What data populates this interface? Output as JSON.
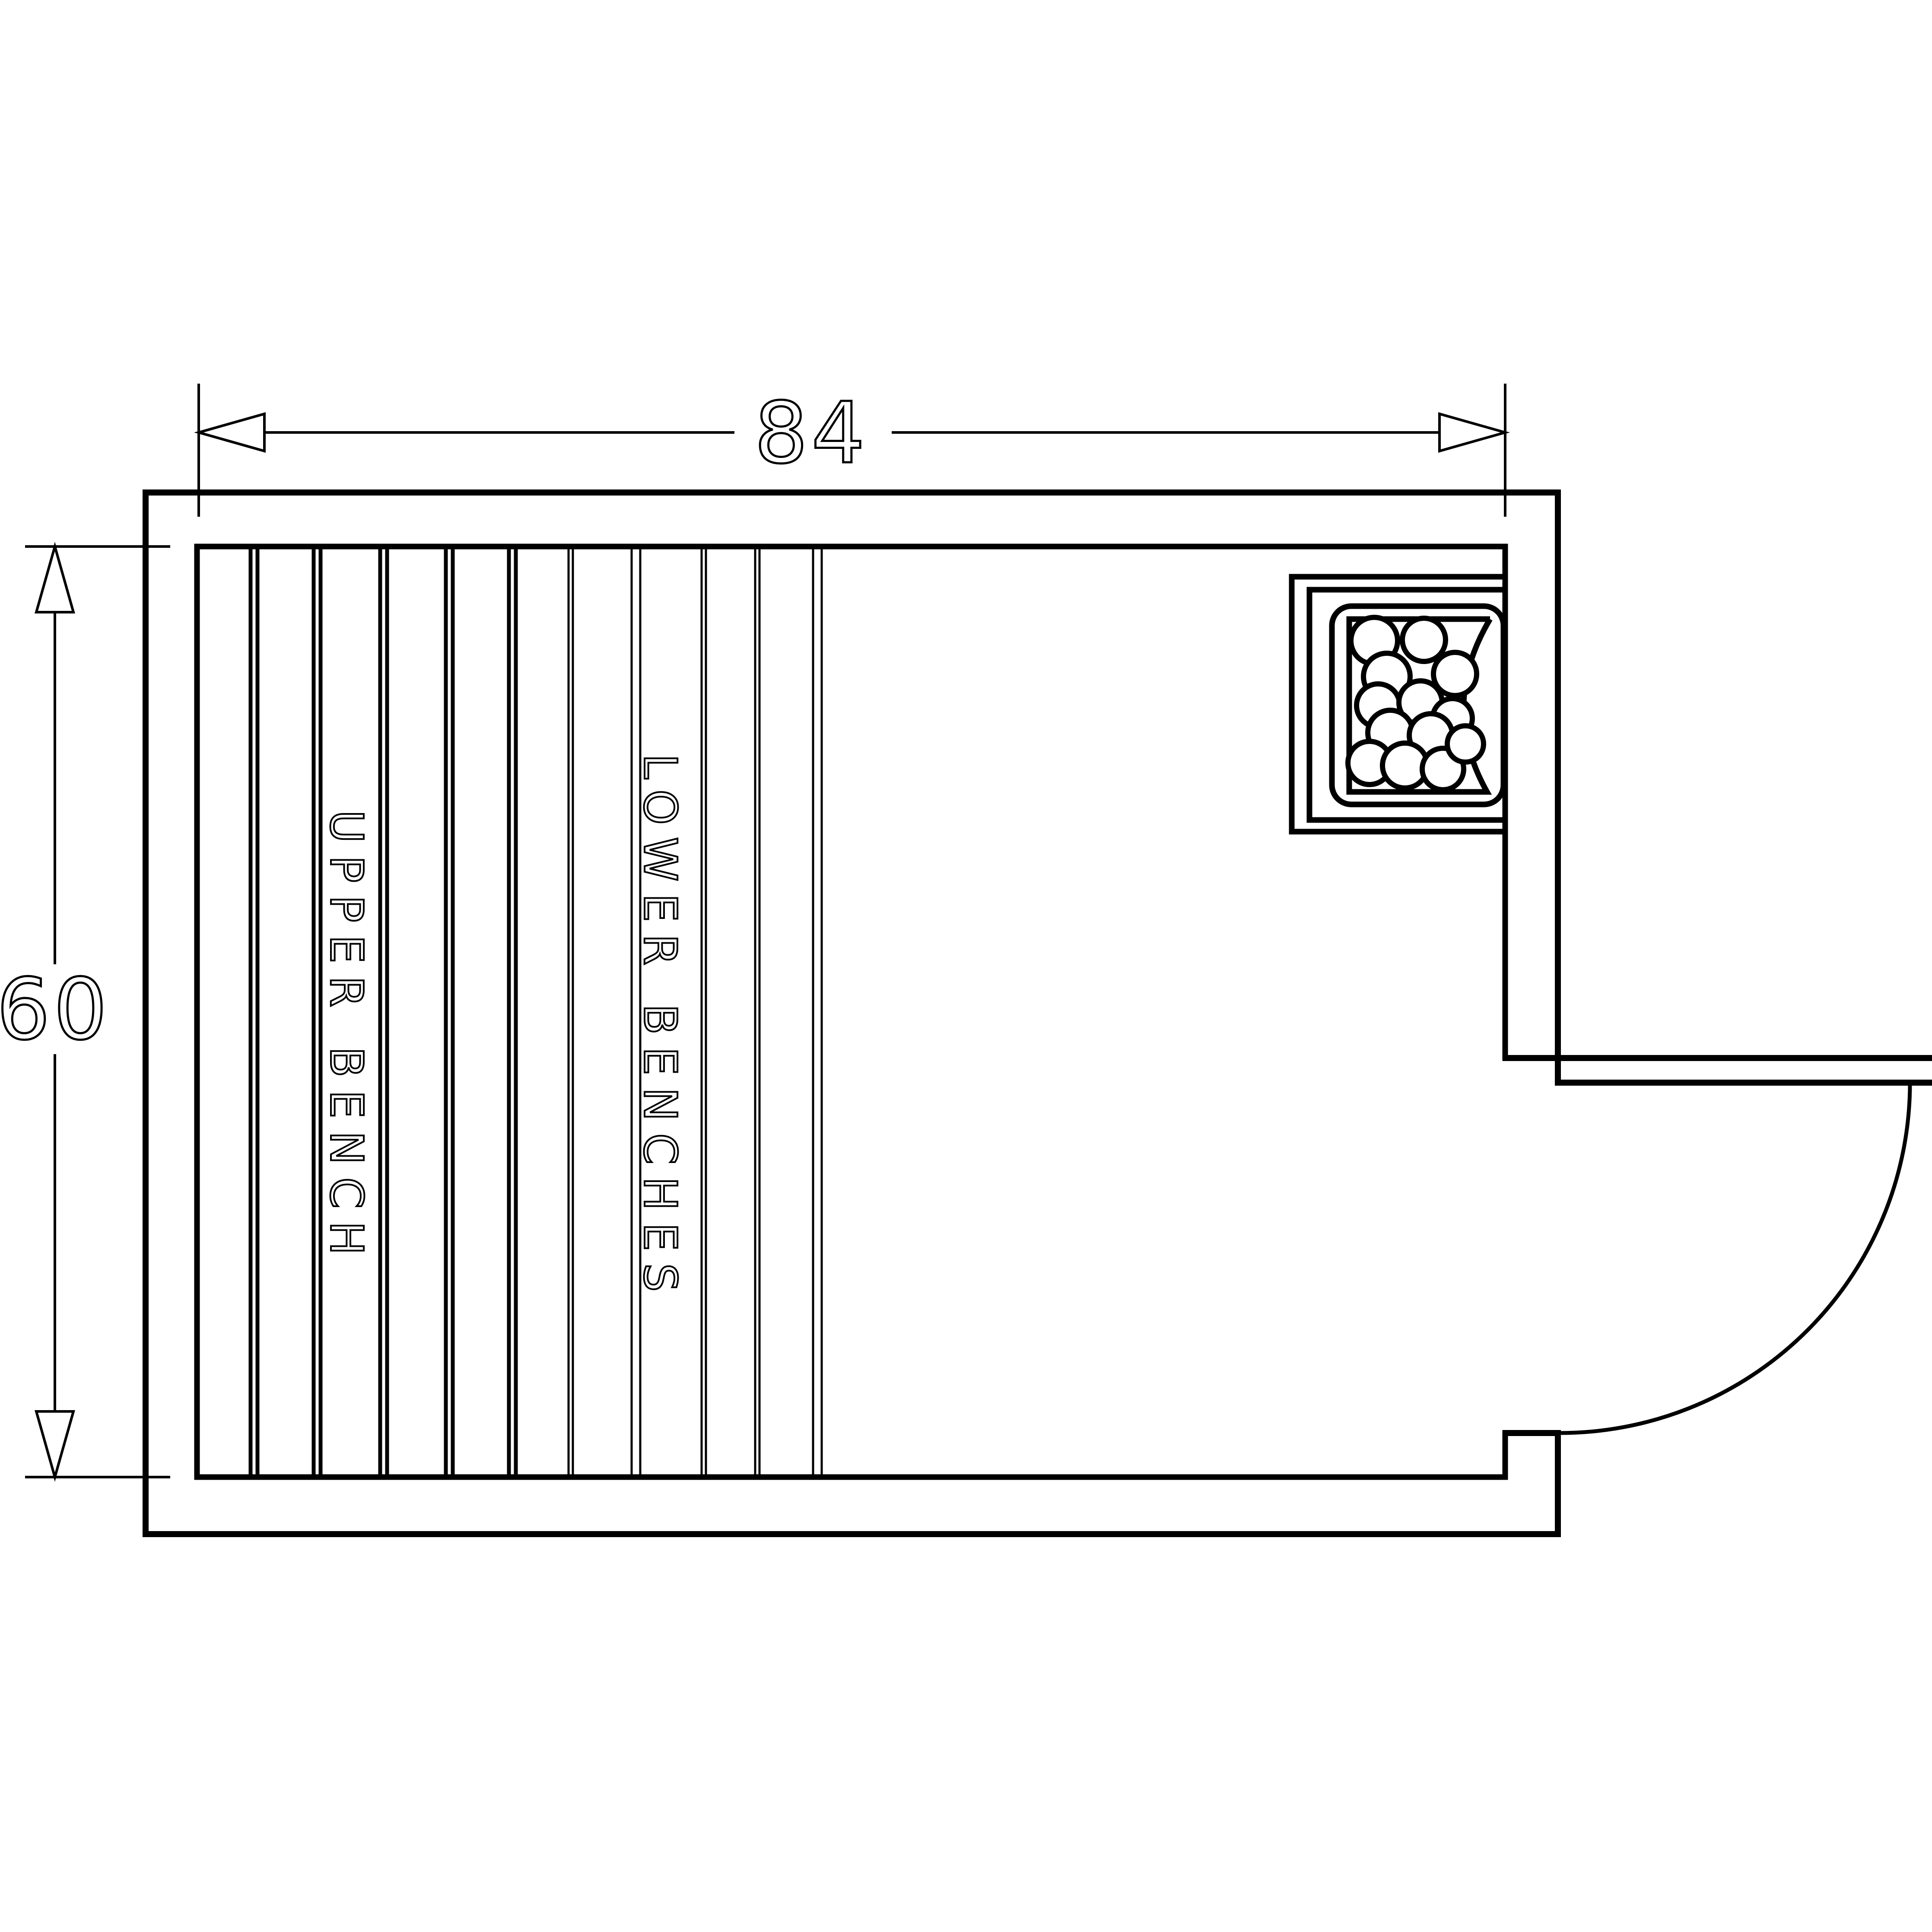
{
  "drawing": {
    "dimensions": {
      "width_label": "84",
      "height_label": "60"
    },
    "labels": {
      "upper_bench": "UPPER BENCH",
      "lower_benches": "LOWER BENCHES"
    },
    "colors": {
      "line": "#000000",
      "background": "#ffffff"
    }
  }
}
